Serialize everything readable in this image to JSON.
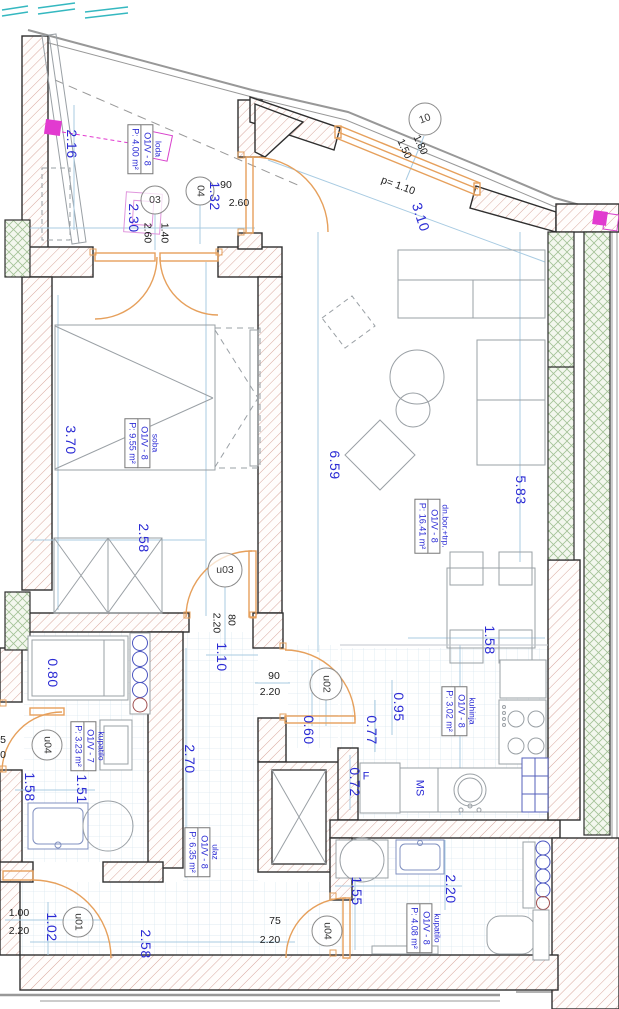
{
  "plan": {
    "rooms": [
      {
        "id": "loda",
        "name": "loda",
        "unit": "O1/V - 8",
        "area": "P: 4.00 m²"
      },
      {
        "id": "soba",
        "name": "soba",
        "unit": "O1/V - 8",
        "area": "P: 9.55 m²"
      },
      {
        "id": "dnevni-boravak-trpezarija",
        "name": "dn.bor.+trp.",
        "unit": "O1/V - 8",
        "area": "P: 16.41 m²"
      },
      {
        "id": "kuhinja",
        "name": "kuhinja",
        "unit": "O1/V - 8",
        "area": "P: 3.02 m²"
      },
      {
        "id": "kupatilo-1",
        "name": "kupatilo",
        "unit": "O1/V - 7",
        "area": "P: 3.23 m²"
      },
      {
        "id": "ulaz",
        "name": "ulaz",
        "unit": "O1/V - 8",
        "area": "P: 6.35 m²"
      },
      {
        "id": "kupatilo-2",
        "name": "kupatilo",
        "unit": "O1/V - 8",
        "area": "P: 4.08 m²"
      }
    ],
    "door_tags": {
      "d03": "03",
      "d04": "04",
      "w10": "10",
      "u03": "u03",
      "u02": "u02",
      "u04a": "u04",
      "u01": "u01",
      "u04b": "u04"
    },
    "dims_blue": {
      "loda_height": "2.16",
      "loda_w1": "2.30",
      "loda_w2": "1.32",
      "facade_len": "3.10",
      "soba_height": "3.70",
      "living_len": "6.59",
      "living_len2": "5.83",
      "soba_width": "2.58",
      "hall_opening": "1.10",
      "shower_w": "0.80",
      "bath1_w1": "1.58",
      "bath1_w2": "1.51",
      "hall_width": "2.70",
      "k_seg1": "0.60",
      "k_seg2": "0.77",
      "k_seg3": "0.95",
      "k_seg4": "0.72",
      "kitchen_w": "1.58",
      "entry_seg": "1.02",
      "corridor_len": "2.58",
      "bath2_h": "1.55",
      "bath2_w": "2.20"
    },
    "dims_black": {
      "door04_w": "90",
      "door04_h": "2.60",
      "door03_w": "1.40",
      "door03_h": "2.60",
      "win10_w": "1.80",
      "win10_h": "1.50",
      "parapet_note": "p= 1.10",
      "u03_w": "80",
      "u03_h": "2.20",
      "u02_w": "90",
      "u02_h": "2.20",
      "u01_w": "1.00",
      "u01_h": "2.20",
      "u04b_w": "75",
      "u04b_h": "2.20",
      "edge_digit_top": "5",
      "edge_digit_bottom": "0"
    },
    "fixtures": {
      "fridge": "F",
      "sink_unit": "MS"
    },
    "colors": {
      "dim_blue": "#2b2bd4",
      "wall_hatch": "#d8a89e",
      "green_hatch": "#a3c296",
      "door_orange": "#e6a05c",
      "magenta": "#e23ad0",
      "cyan_marks": "#35b8c0",
      "dim_line": "#a8cbe2"
    }
  }
}
